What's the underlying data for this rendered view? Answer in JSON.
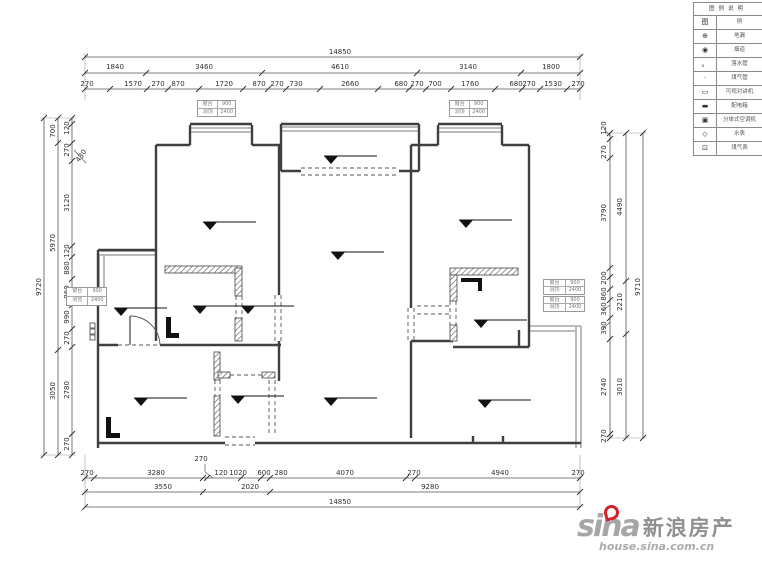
{
  "dims": {
    "top": {
      "total": "14850",
      "row2": [
        "1840",
        "3460",
        "4610",
        "3140",
        "1800"
      ],
      "row3": [
        "270",
        "1570",
        "270",
        "870",
        "1720",
        "870",
        "270",
        "730",
        "2660",
        "680",
        "270",
        "700",
        "1760",
        "680",
        "270",
        "1530",
        "270"
      ]
    },
    "bottom": {
      "total": "14850",
      "row1": [
        "270",
        "3280",
        "120",
        "1020",
        "600",
        "280",
        "4070",
        "270",
        "4940",
        "270"
      ],
      "row2": [
        "3550",
        "2020",
        "9280"
      ],
      "leader": "270"
    },
    "left": {
      "outer": "9720",
      "middle": [
        "700",
        "5970",
        "3050"
      ],
      "inner": [
        "120",
        "270",
        "3120",
        "120",
        "880",
        "860",
        "990",
        "270",
        "2780",
        "270"
      ],
      "leader": "430"
    },
    "right": {
      "outer": "9710",
      "middle": [
        "4490",
        "2210",
        "3010"
      ],
      "inner": [
        "120",
        "270",
        "3790",
        "200",
        "860",
        "360",
        "390",
        "2740",
        "270"
      ]
    }
  },
  "legend": {
    "title": "图例说明",
    "header": {
      "symbol": "图",
      "name": "例"
    },
    "rows": [
      {
        "icon": "⊕",
        "label": "地漏"
      },
      {
        "icon": "◉",
        "label": "烟道"
      },
      {
        "icon": "。",
        "label": "落水管"
      },
      {
        "icon": "·",
        "label": "煤气管"
      },
      {
        "icon": "▭",
        "label": "可视对讲机"
      },
      {
        "icon": "▬",
        "label": "配电箱"
      },
      {
        "icon": "▣",
        "label": "分体式空调机"
      },
      {
        "icon": "◇",
        "label": "水表"
      },
      {
        "icon": "⊡",
        "label": "煤气表"
      }
    ]
  },
  "window_tags": {
    "sill_label": "窗台",
    "sill_value": "900",
    "head_label": "洞顶",
    "head_value": "2400"
  },
  "logo": {
    "sina": "sina",
    "brand": "新浪房产",
    "url": "house.sina.com.cn",
    "red": "#d2232a"
  },
  "colors": {
    "wall": "#3f3f3f",
    "window_gray": "#b3b3b3",
    "dim_line": "#555555"
  }
}
